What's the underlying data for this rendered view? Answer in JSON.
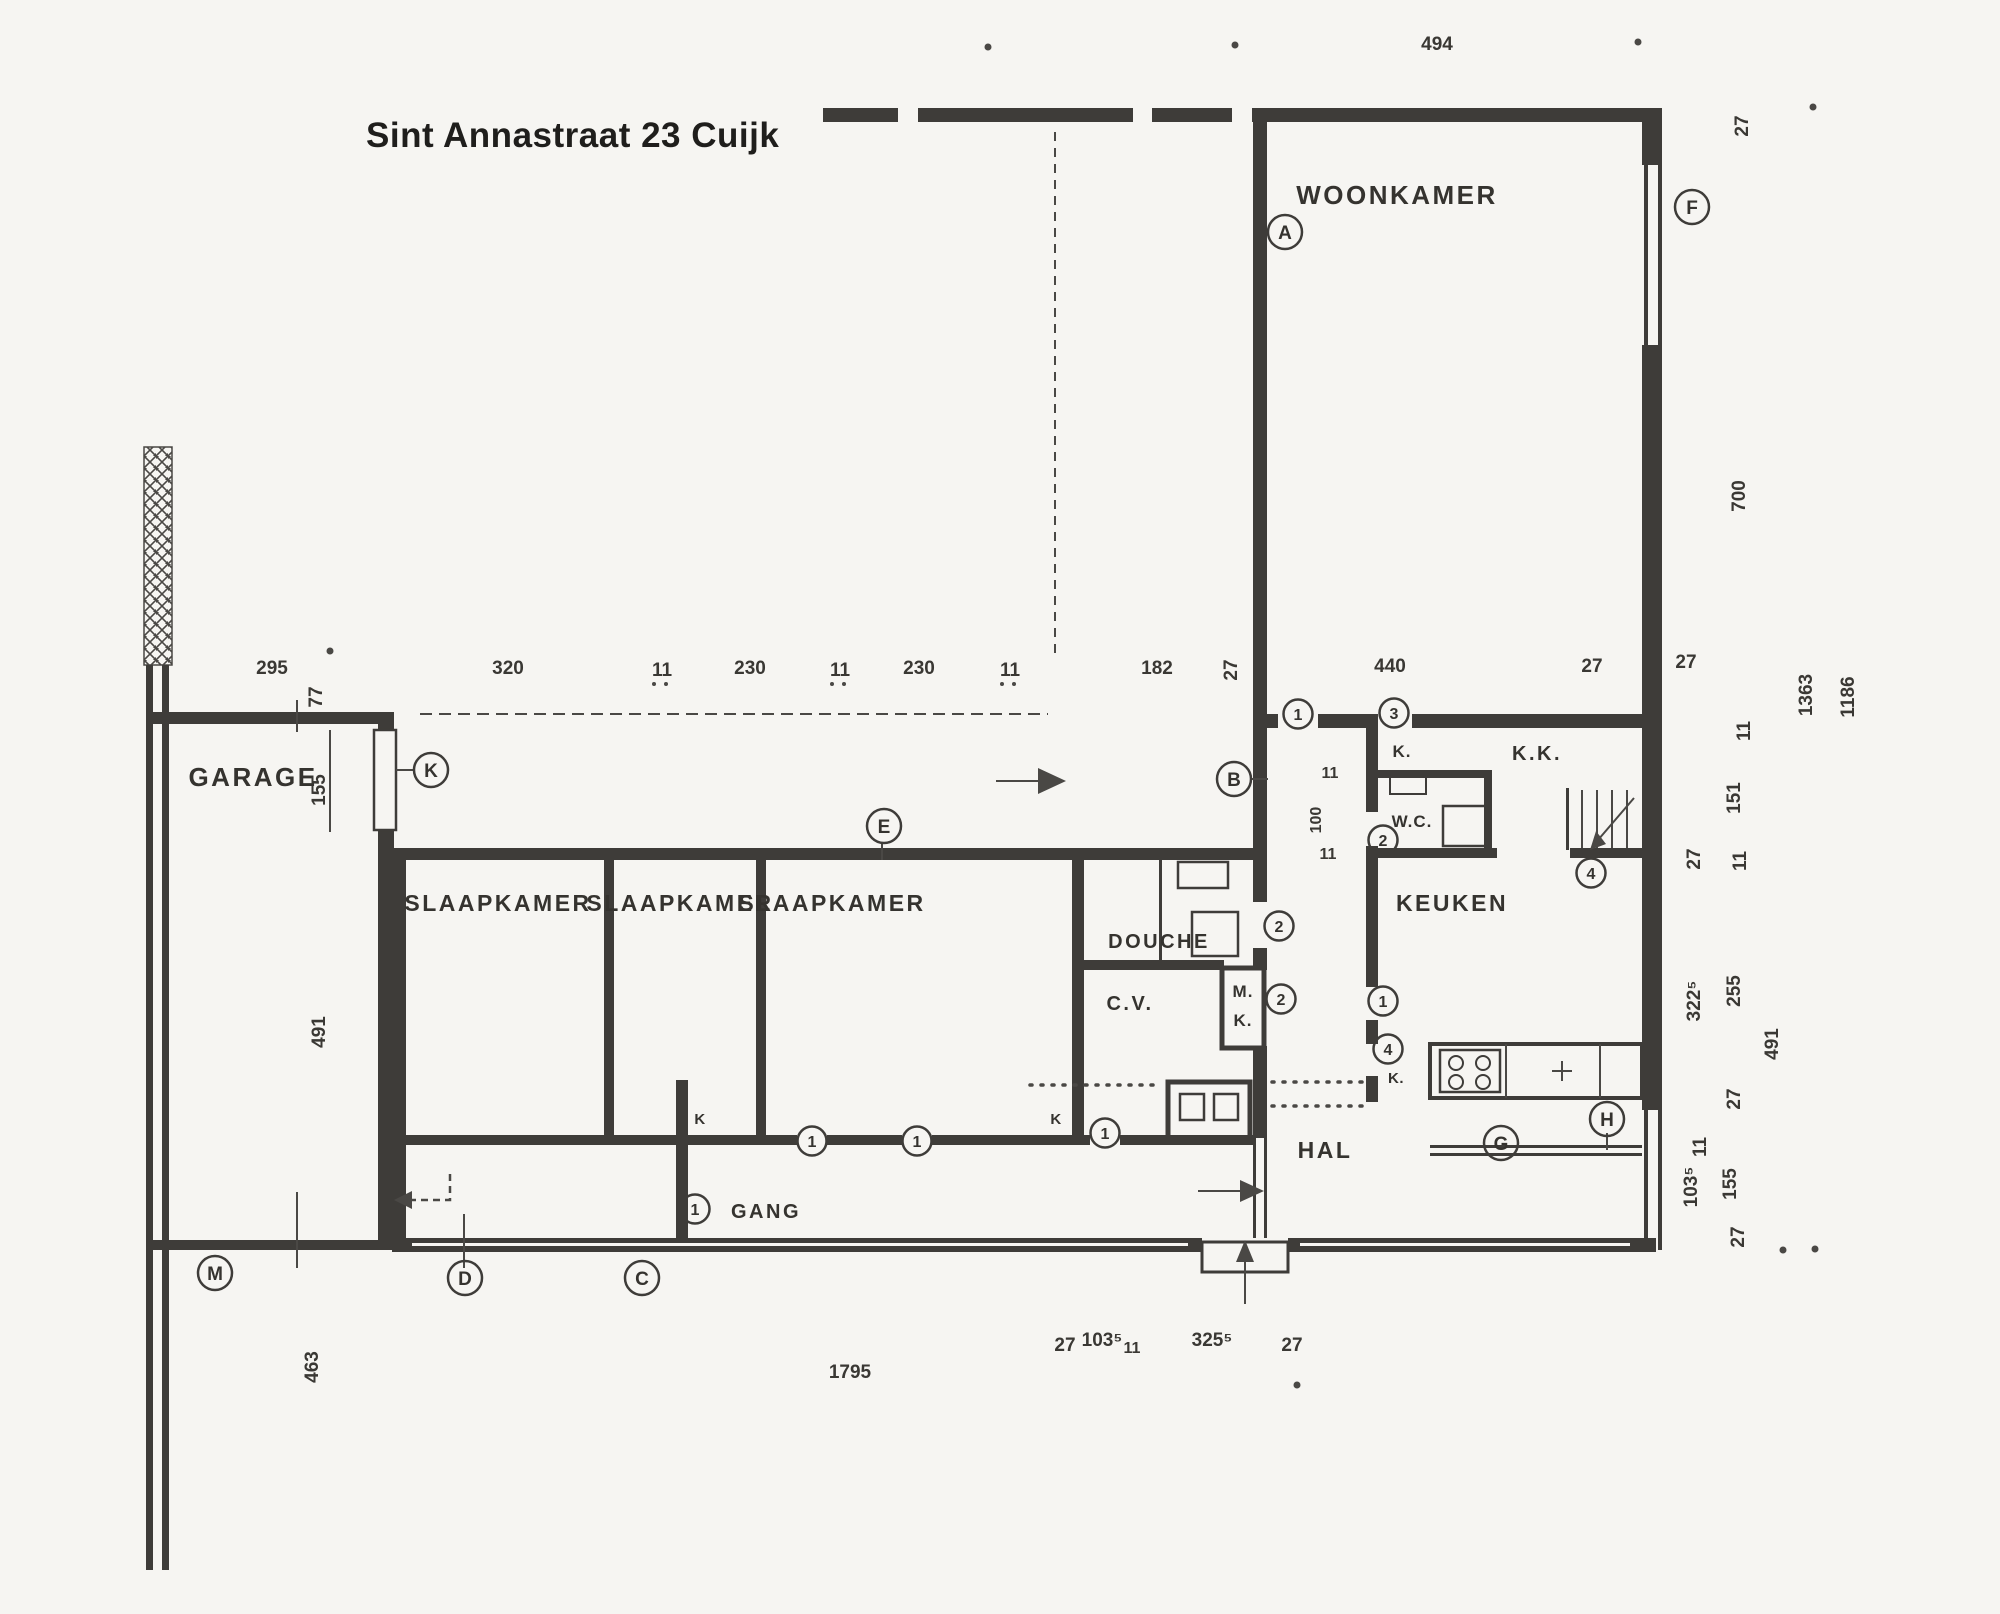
{
  "title": "Sint Annastraat 23 Cuijk",
  "rooms": {
    "woonkamer": "WOONKAMER",
    "garage": "GARAGE",
    "slaapkamer": "SLAAPKAMER",
    "douche": "DOUCHE",
    "cv": "C.V.",
    "mk_m": "M.",
    "mk_k": "K.",
    "keuken": "KEUKEN",
    "kast_dot": "K.",
    "kk": "K.K.",
    "wc": "W.C.",
    "hal": "HAL",
    "gang": "GANG",
    "kast": "K"
  },
  "dims": {
    "n494": "494",
    "n295": "295",
    "n77": "77",
    "n320": "320",
    "n11": "11",
    "n230": "230",
    "n182": "182",
    "n27": "27",
    "n440": "440",
    "n700": "700",
    "n1363": "1363",
    "n1186": "1186",
    "n151": "151",
    "n100": "100",
    "n322_5": "322⁵",
    "n255": "255",
    "n491": "491",
    "n103_5": "103⁵",
    "n155": "155",
    "n325_5": "325⁵",
    "n1795": "1795",
    "n463": "463"
  },
  "markers": {
    "a": "A",
    "b": "B",
    "c": "C",
    "d": "D",
    "e": "E",
    "f": "F",
    "g": "G",
    "h": "H",
    "k": "K",
    "m": "M",
    "n1": "1",
    "n2": "2",
    "n3": "3",
    "n4": "4"
  }
}
